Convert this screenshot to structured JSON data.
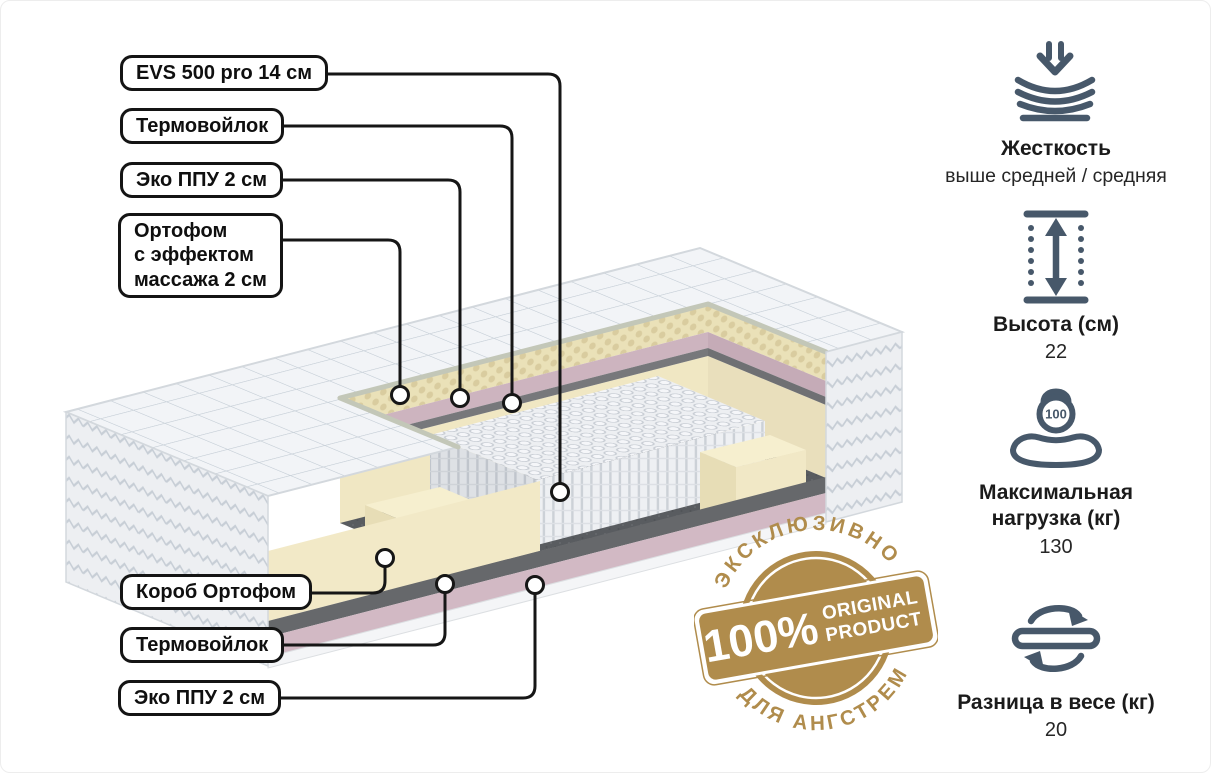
{
  "callouts": {
    "top": [
      "EVS 500 pro 14 см",
      "Термовойлок",
      "Эко ППУ 2 см",
      "Ортофом\nс эффектом\nмассажа 2 см"
    ],
    "bottom": [
      "Короб Ортофом",
      "Термовойлок",
      "Эко ППУ 2 см"
    ]
  },
  "badge": {
    "arc_top": "ЭКСКЛЮЗИВНО",
    "arc_bottom": "ДЛЯ АНГСТРЕМ",
    "percent": "100%",
    "word1": "ORIGINAL",
    "word2": "PRODUCT",
    "gold": "#b08c4c"
  },
  "specs": [
    {
      "icon": "firmness-icon",
      "title": "Жесткость",
      "value": "выше средней / средняя"
    },
    {
      "icon": "height-icon",
      "title": "Высота (см)",
      "value": "22"
    },
    {
      "icon": "max-load-icon",
      "title": "Максимальная нагрузка (кг)",
      "value": "130",
      "badge_number": "100"
    },
    {
      "icon": "flip-icon",
      "title": "Разница в весе (кг)",
      "value": "20"
    }
  ],
  "colors": {
    "icon": "#47586a",
    "callout_line": "#161616",
    "gold": "#b08c4c",
    "quilt_white": "#f2f4f7",
    "foam_cream": "#f0e7c3",
    "eco_ppu_pink": "#cdb4bf",
    "thermo_felt_gray": "#66686b",
    "springs_white": "#eef0f3"
  }
}
